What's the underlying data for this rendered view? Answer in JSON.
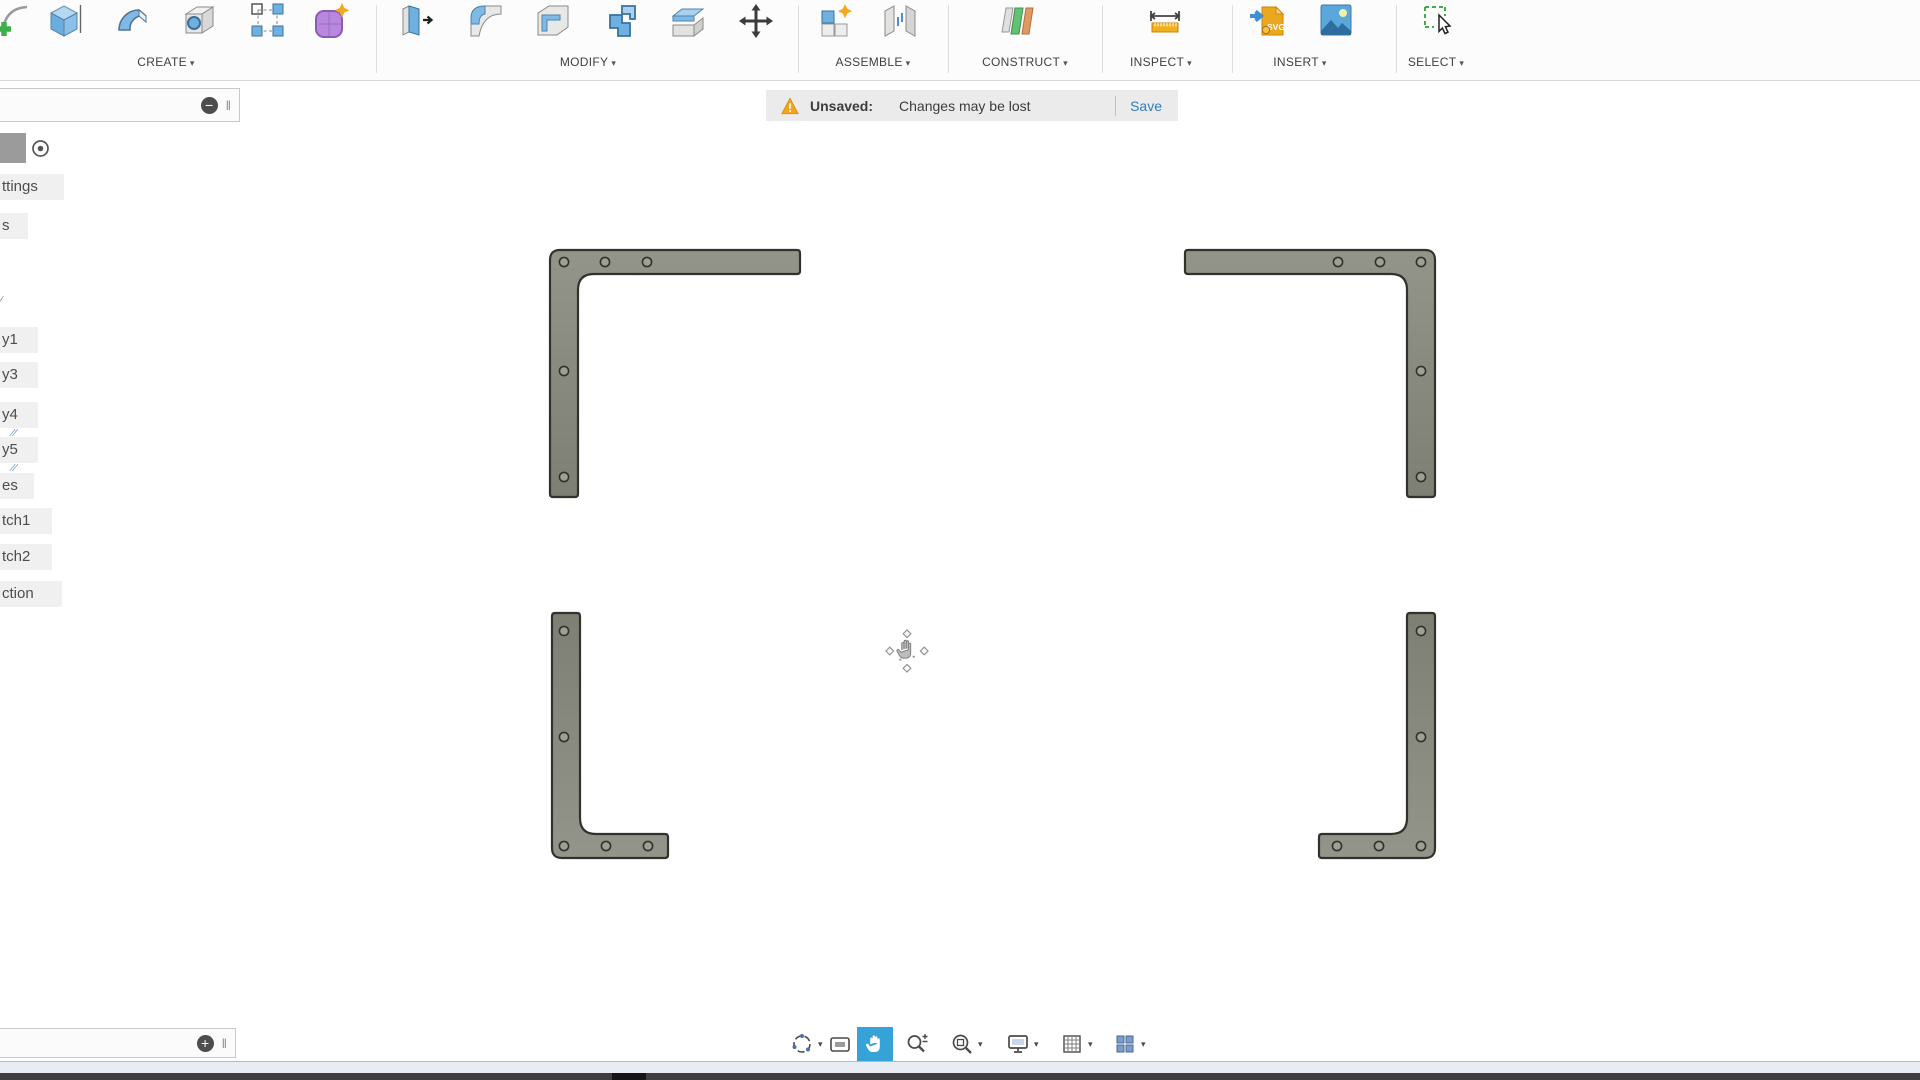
{
  "top_toolbar": {
    "caret": "▾",
    "sections": [
      {
        "label": "CREATE",
        "items": [
          {
            "icon": "create-sketch"
          },
          {
            "icon": "box"
          },
          {
            "icon": "sweep"
          },
          {
            "icon": "hole"
          },
          {
            "icon": "rectangular-pattern"
          },
          {
            "icon": "create-form"
          }
        ]
      },
      {
        "label": "MODIFY",
        "items": [
          {
            "icon": "press-pull"
          },
          {
            "icon": "fillet"
          },
          {
            "icon": "shell"
          },
          {
            "icon": "combine"
          },
          {
            "icon": "split-body"
          },
          {
            "icon": "move"
          }
        ]
      },
      {
        "label": "ASSEMBLE",
        "items": [
          {
            "icon": "new-component"
          },
          {
            "icon": "joint"
          }
        ]
      },
      {
        "label": "CONSTRUCT",
        "items": [
          {
            "icon": "offset-plane"
          }
        ]
      },
      {
        "label": "INSPECT",
        "items": [
          {
            "icon": "measure"
          }
        ]
      },
      {
        "label": "INSERT",
        "items": [
          {
            "icon": "insert-svg"
          },
          {
            "icon": "insert-decal"
          }
        ]
      },
      {
        "label": "SELECT",
        "items": [
          {
            "icon": "select"
          }
        ]
      }
    ]
  },
  "unsaved_bar": {
    "icon": "warning-triangle",
    "label": "Unsaved:",
    "message": "Changes may be lost",
    "save_label": "Save"
  },
  "browser_panel": {
    "collapse_glyph": "−",
    "expand_glyph": "+",
    "grip_glyph": "‖",
    "pencil_glyph": "∕",
    "mark_glyph": "⁄⁄",
    "swatch_icon": "gray-swatch",
    "radio_icon": "radio-dot",
    "rows": [
      {
        "label": "ttings"
      },
      {
        "label": "s"
      },
      {
        "label": "y1"
      },
      {
        "label": "y3"
      },
      {
        "label": "y4",
        "marks": true
      },
      {
        "label": "y5",
        "marks": true
      },
      {
        "label": "es"
      },
      {
        "label": "tch1"
      },
      {
        "label": "tch2"
      },
      {
        "label": "ction"
      }
    ]
  },
  "nav_toolbar": {
    "caret": "▾",
    "active_color": "#35a3d7",
    "items": [
      {
        "icon": "orbit",
        "caret": true
      },
      {
        "icon": "look-at"
      },
      {
        "icon": "pan",
        "active": true
      },
      {
        "icon": "zoom"
      },
      {
        "icon": "fit",
        "caret": true
      },
      {
        "icon": "display-settings",
        "caret": true
      },
      {
        "icon": "grid-snaps",
        "caret": true
      },
      {
        "icon": "viewports",
        "caret": true
      }
    ]
  },
  "canvas": {
    "cursor_icon": "pan-cursor",
    "bracket_fill": "#8a8b80",
    "bracket_edge": "#32322c",
    "hole_fill": "#9fa095",
    "brackets": [
      {
        "id": "top-left",
        "corner": "tl",
        "x": 550,
        "y": 250,
        "w": 250,
        "h": 247,
        "arm": 24,
        "web": 28,
        "holes": [
          [
            564,
            262
          ],
          [
            605,
            262
          ],
          [
            647,
            262
          ],
          [
            564,
            371
          ],
          [
            564,
            477
          ]
        ]
      },
      {
        "id": "top-right",
        "corner": "tr",
        "x": 1185,
        "y": 250,
        "w": 250,
        "h": 247,
        "arm": 24,
        "web": 28,
        "holes": [
          [
            1421,
            262
          ],
          [
            1380,
            262
          ],
          [
            1338,
            262
          ],
          [
            1421,
            371
          ],
          [
            1421,
            477
          ]
        ]
      },
      {
        "id": "bottom-left",
        "corner": "bl",
        "x": 552,
        "y": 613,
        "w": 116,
        "h": 245,
        "arm": 24,
        "web": 28,
        "holes": [
          [
            564,
            631
          ],
          [
            564,
            737
          ],
          [
            564,
            846
          ],
          [
            606,
            846
          ],
          [
            648,
            846
          ]
        ]
      },
      {
        "id": "bottom-right",
        "corner": "br",
        "x": 1319,
        "y": 613,
        "w": 116,
        "h": 245,
        "arm": 24,
        "web": 28,
        "holes": [
          [
            1421,
            631
          ],
          [
            1421,
            737
          ],
          [
            1421,
            846
          ],
          [
            1379,
            846
          ],
          [
            1337,
            846
          ]
        ]
      }
    ]
  },
  "colors": {
    "save_link": "#2d7dc2",
    "warning": "#f2a41c",
    "toolbar_label": "#3f3f3f",
    "nav_active": "#35a3d7"
  }
}
